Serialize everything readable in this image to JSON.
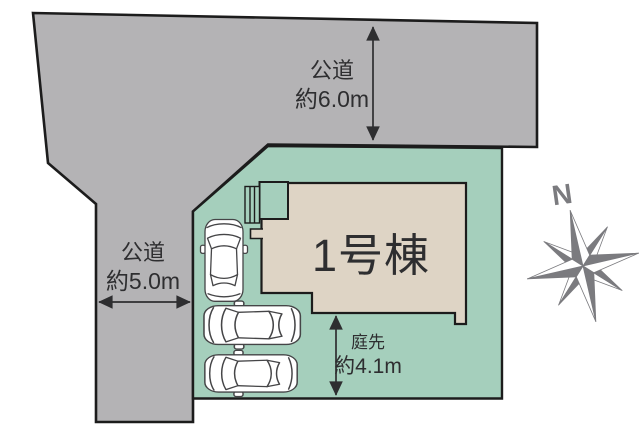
{
  "site_plan": {
    "building": {
      "label": "1号棟"
    },
    "dimensions": {
      "road_top": {
        "name": "公道",
        "value": "約6.0m"
      },
      "road_left": {
        "name": "公道",
        "value": "約5.0m"
      },
      "garden": {
        "name": "庭先",
        "value": "約4.1m"
      }
    },
    "compass": {
      "north_label": "N"
    },
    "parking": {
      "car_count": 3
    }
  },
  "colors": {
    "road": "#b4b3b5",
    "plot": "#a5cfbc",
    "building": "#ded4c5",
    "outline": "#1c1c1c",
    "text": "#2e2e30",
    "compass": "#7b7b7f",
    "car": "#454547"
  },
  "icons": {
    "compass": "compass-rose-icon",
    "car": "car-top-view-icon",
    "arrow": "dimension-arrow-icon"
  }
}
